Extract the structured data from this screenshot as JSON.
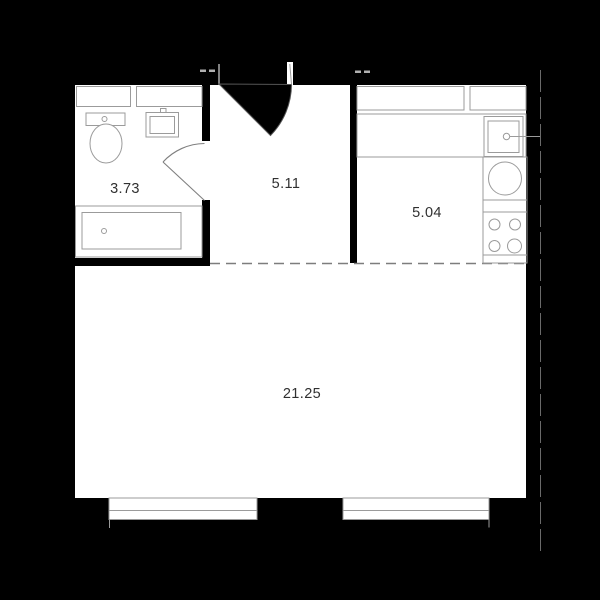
{
  "floorplan": {
    "rooms": [
      {
        "name": "bathroom",
        "area": "3.73"
      },
      {
        "name": "hallway",
        "area": "5.11"
      },
      {
        "name": "kitchen",
        "area": "5.04"
      },
      {
        "name": "living-room",
        "area": "21.25"
      }
    ],
    "colors": {
      "background": "#000000",
      "wall": "#000000",
      "floor": "#ffffff",
      "fixture_outline": "#9b9b9b",
      "dashed_zone_line": "#7d7d7d",
      "label_text": "#303030"
    },
    "icons": [
      "entrance-door-icon",
      "bathroom-door-icon",
      "toilet-icon",
      "washbasin-icon",
      "bathtub-icon",
      "shelf-icon",
      "kitchen-cabinet-icon",
      "kitchen-sink-icon",
      "faucet-icon",
      "washer-icon",
      "stove-icon",
      "window-icon"
    ]
  }
}
